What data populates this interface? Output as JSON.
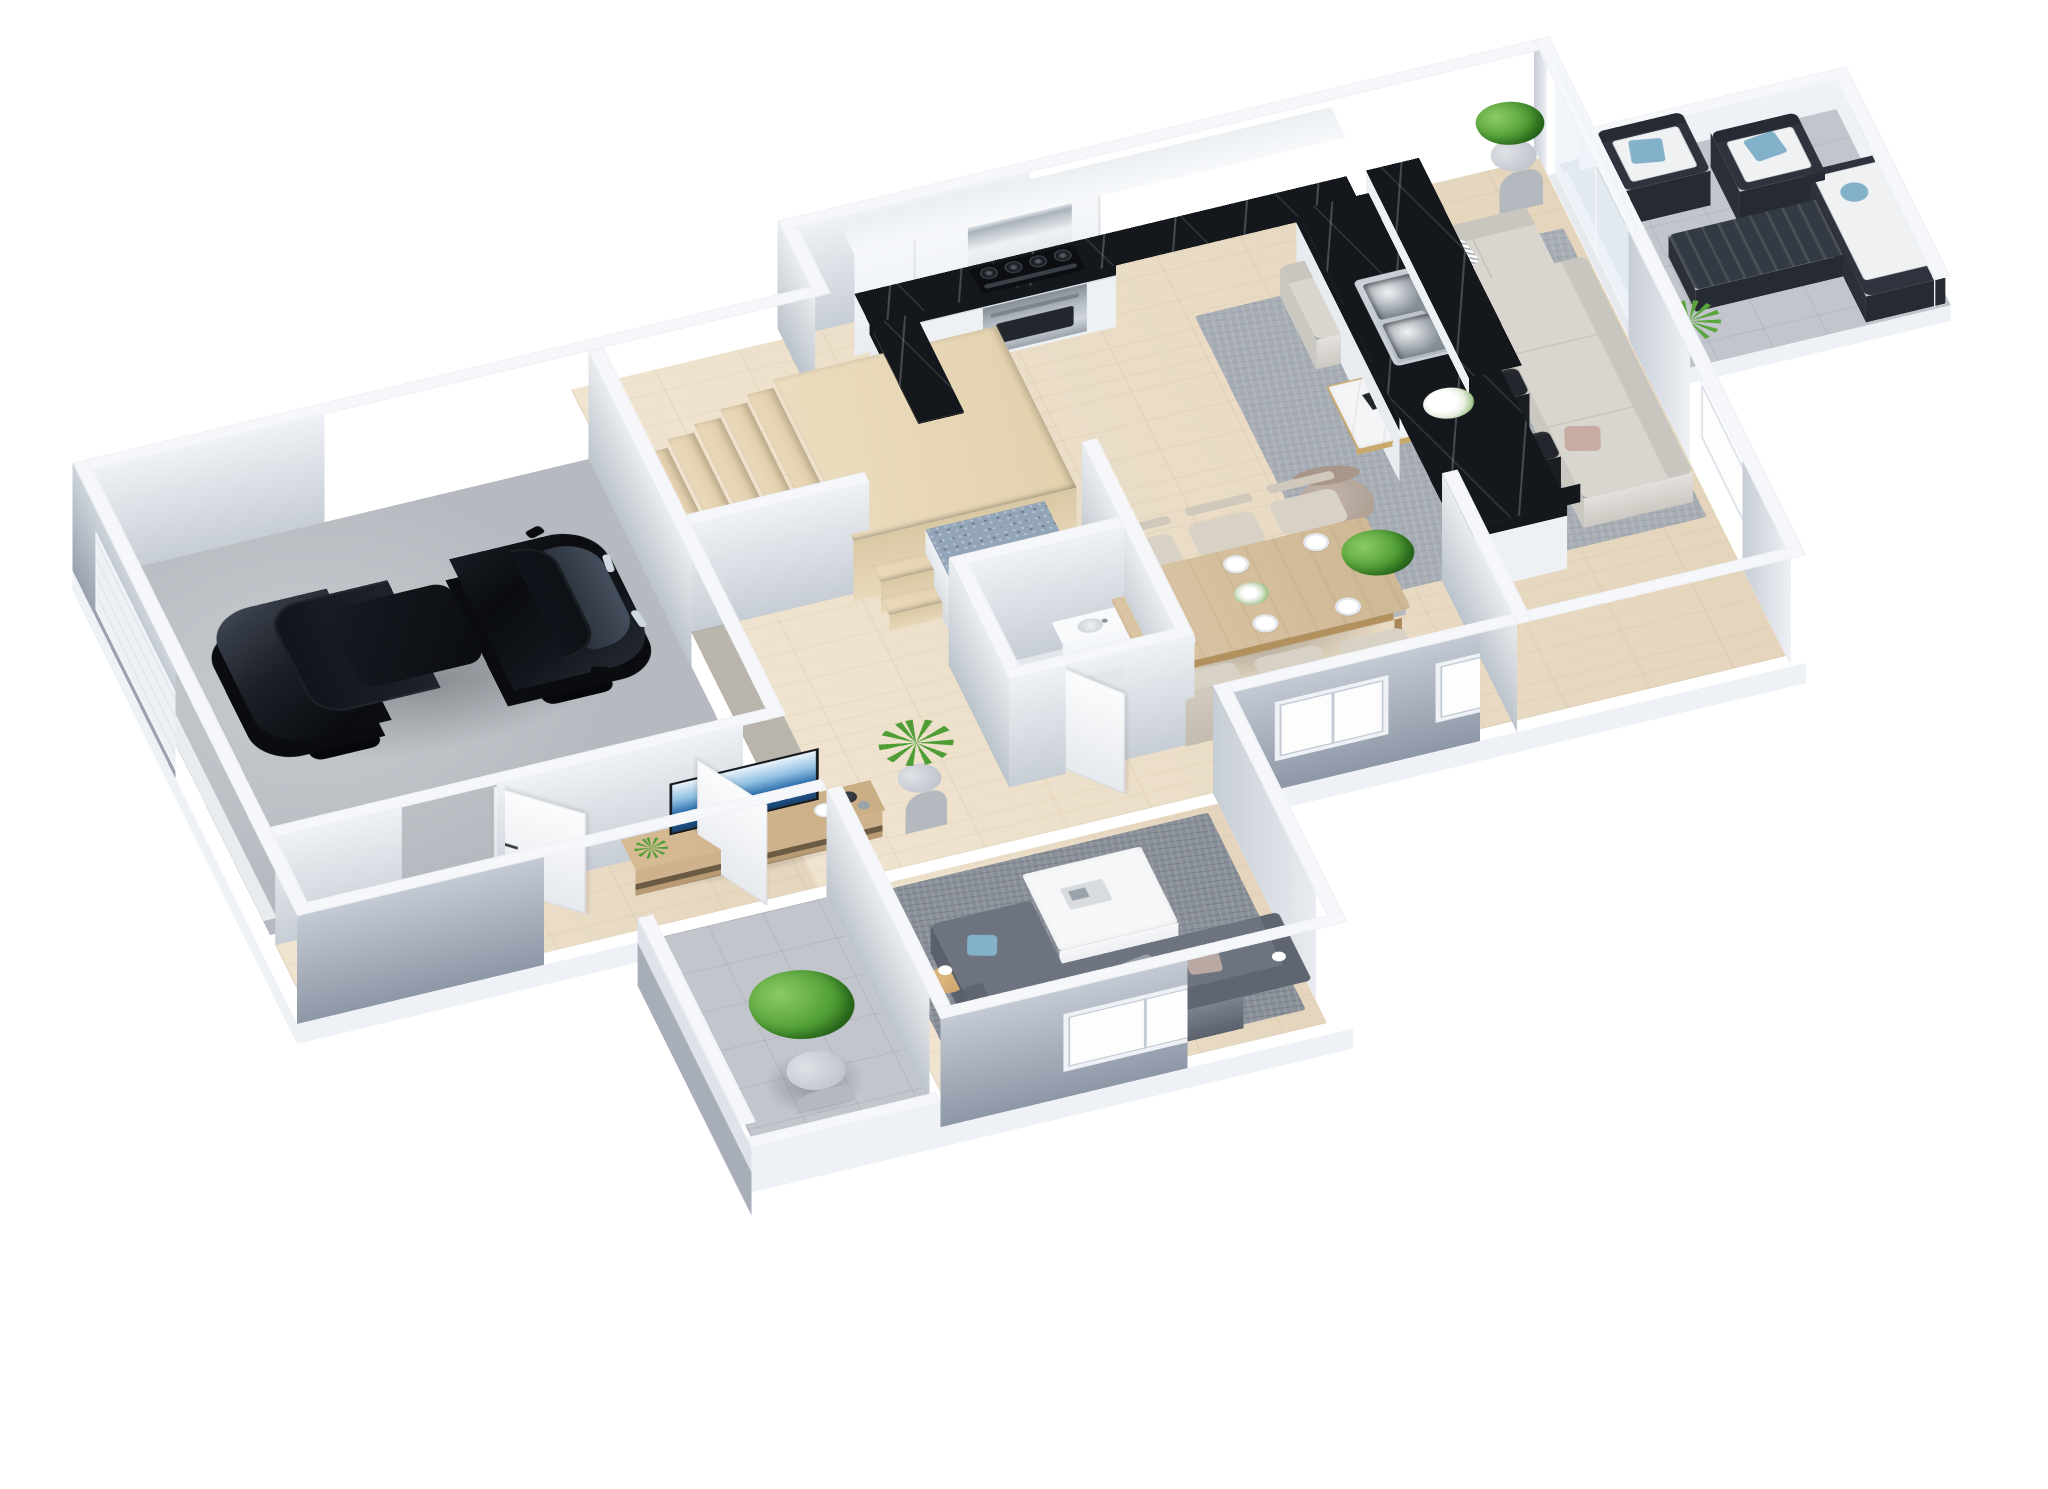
{
  "scene": {
    "type": "isometric-3d-floor-plan",
    "level": "ground-floor",
    "background": "#ffffff",
    "labels": {
      "plan": "3D ground floor plan rendering",
      "garage": "Garage",
      "stairs": "Staircase",
      "powder": "Powder Room",
      "kitchen": "Kitchen",
      "dining": "Dining Area",
      "living": "Living Room",
      "family": "Family Room",
      "hall": "Hallway",
      "porch": "Entry Porch",
      "patio": "Patio"
    }
  },
  "colors": {
    "wall-top": "#f5f7fa",
    "wall-in-1": "#c7cdd5",
    "wall-in-2": "#eef1f5",
    "wall-ex-1": "#8e97a6",
    "wall-ex-2": "#c3cad4",
    "wood-1": "#f0e4d0",
    "wood-2": "#e4d5bc",
    "garage-floor": "#b6bac0",
    "tile": "#c7cbd1",
    "marble-dark": "#14171c",
    "island-blue": "#93a5b8",
    "rug-living": "#a7adb4",
    "rug-family": "#8a9099",
    "sofa-light": "#d9d6d0",
    "sofa-dark": "#6d7480",
    "wood-furn": "#cdb28d",
    "table-wood": "#d9c4a4",
    "chair-beige": "#d8d1c5",
    "plant": "#4f9e35",
    "plant-dark": "#2f7320",
    "car": "#0b0d11",
    "pillow-blue": "#82b1c9",
    "frame-dark": "#2e333d",
    "gold": "#c9a96a"
  },
  "rooms": {
    "garage": {
      "label": "Garage",
      "floor": "concrete",
      "contents": [
        "black SUV",
        "window"
      ]
    },
    "stairs": {
      "label": "Staircase",
      "treads": 6,
      "landing": true,
      "material": "light wood"
    },
    "powder": {
      "label": "Powder Room",
      "contents": [
        "toilet",
        "vanity sink",
        "door"
      ]
    },
    "kitchen": {
      "label": "Kitchen",
      "contents": [
        "white upper cabinets",
        "range hood",
        "gas range with oven",
        "black marble U-counter",
        "raised marble bar",
        "double stainless sink",
        "blue-gray island",
        "4 black bar stools",
        "white flower bouquet",
        "corner planter"
      ]
    },
    "dining": {
      "label": "Dining Area",
      "contents": [
        "wood dining table",
        "6 beige chairs",
        "6 place settings",
        "centerpiece",
        "2 front windows"
      ]
    },
    "living": {
      "label": "Living Room",
      "contents": [
        "gray area rug",
        "light sectional sofa",
        "marble coffee table with gold frame",
        "taupe accent chair",
        "floor plant",
        "framed wall art",
        "patio glass doors"
      ]
    },
    "family": {
      "label": "Family Room",
      "contents": [
        "dark gray sofa with chaise",
        "white coffee table",
        "2 side tables",
        "gray area rug",
        "front window"
      ]
    },
    "hall": {
      "label": "Hallway",
      "contents": [
        "wood TV console",
        "widescreen TV",
        "tall planter",
        "open garage door",
        "open entry door"
      ]
    },
    "porch": {
      "label": "Entry Porch",
      "floor": "gray tile",
      "contents": [
        "boxwood plant in pot",
        "entry door with sidelight"
      ]
    },
    "patio": {
      "label": "Patio",
      "floor": "gray tile",
      "contents": [
        "2 dark lounge chairs with white cushions and blue pillows",
        "dark slatted coffee table",
        "daybed with white cushion and blue pillow",
        "ornamental grass"
      ]
    }
  },
  "furniture_counts": {
    "dining_chairs": 6,
    "bar_stools": 4,
    "patio_lounge_chairs": 2,
    "windows": 7,
    "open_doors": 4
  }
}
